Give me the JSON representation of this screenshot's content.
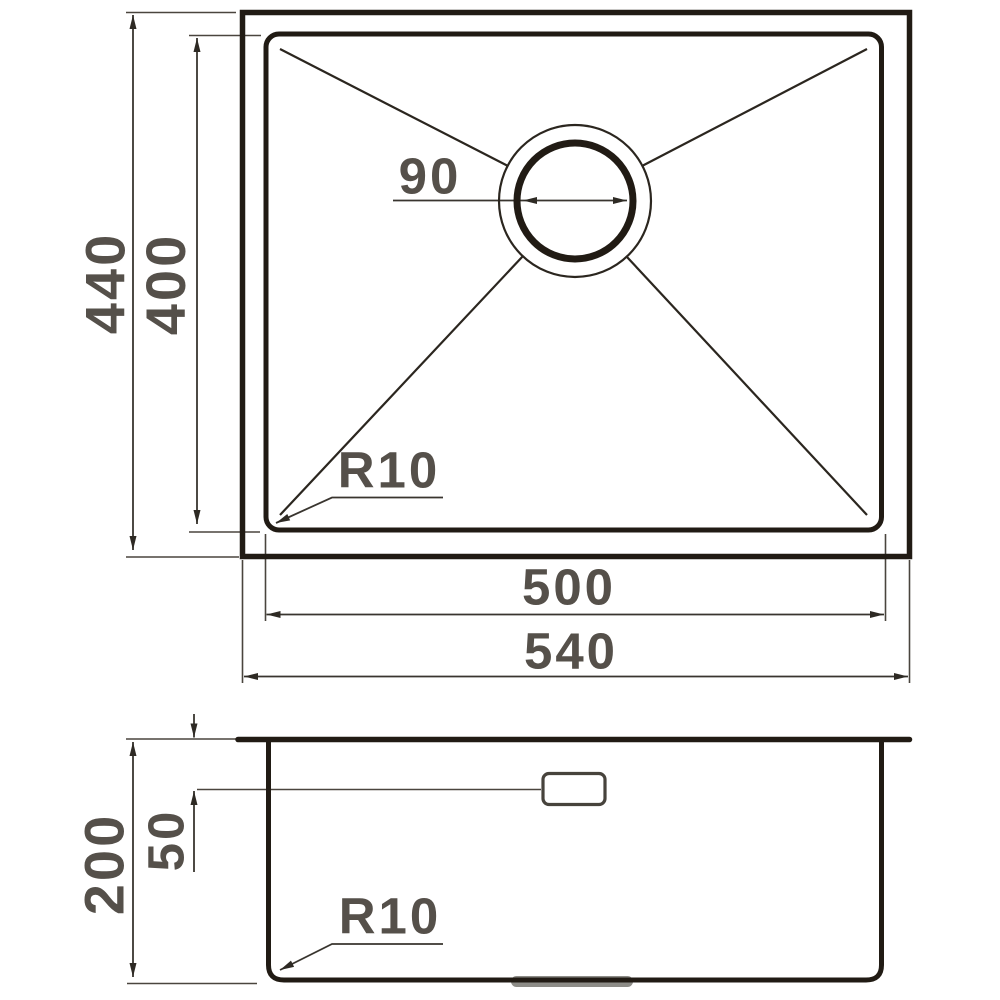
{
  "top_view": {
    "outer_height": "440",
    "inner_height": "400",
    "drain_diameter": "90",
    "corner_radius": "R10",
    "inner_width": "500",
    "outer_width": "540"
  },
  "section_view": {
    "depth": "200",
    "overflow_depth": "50",
    "corner_radius": "R10"
  },
  "colors": {
    "outline": "#211b14",
    "thin_line": "#2b261f",
    "dimension_line": "#39352f",
    "extension_line": "#4a453e",
    "label_text": "#55504a",
    "drain_boss_gray": "#8d8c87",
    "background": "#ffffff"
  }
}
